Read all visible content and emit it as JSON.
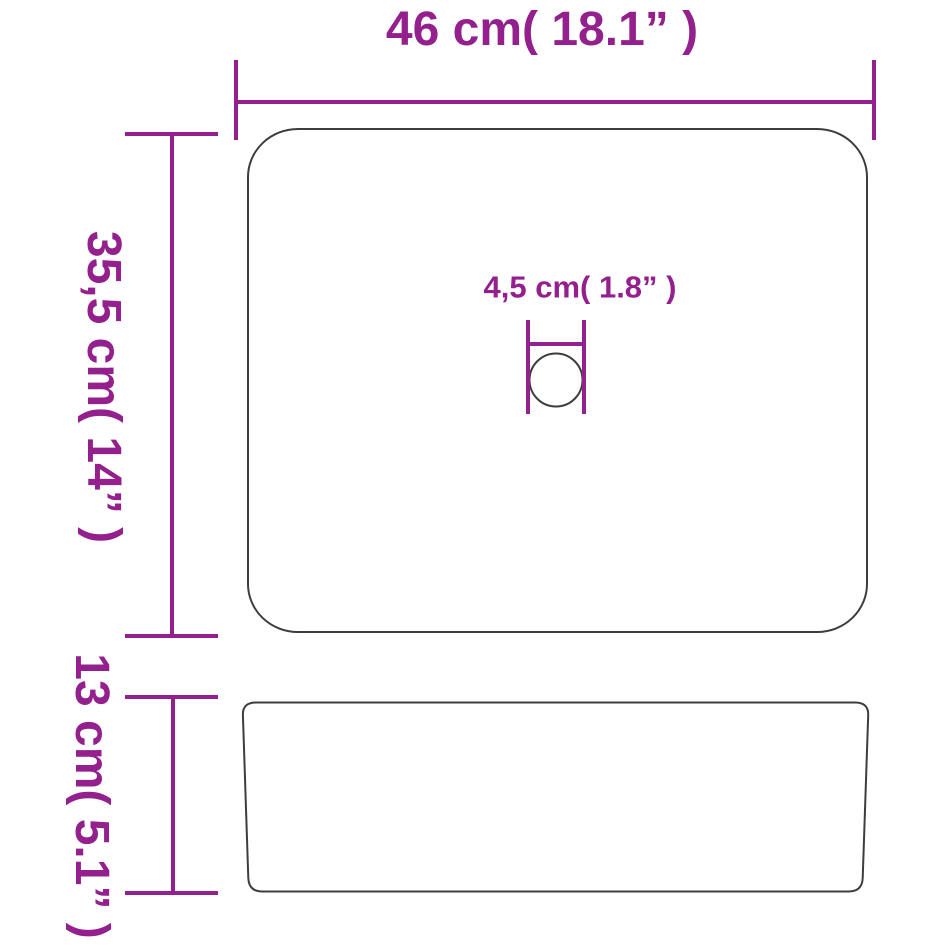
{
  "diagram": {
    "colors": {
      "accent": "#93208c",
      "outline": "#3d3d3d",
      "bg": "#ffffff"
    },
    "labels": {
      "width": "46 cm( 18.1”  )",
      "depth": "35,5 cm( 14”  )",
      "drain": "4,5 cm( 1.8”  )",
      "height": "13 cm( 5.1”  )"
    },
    "measurements": [
      {
        "name": "width",
        "cm": "46",
        "inches": "18.1"
      },
      {
        "name": "depth",
        "cm": "35,5",
        "inches": "14"
      },
      {
        "name": "drain_diameter",
        "cm": "4,5",
        "inches": "1.8"
      },
      {
        "name": "height",
        "cm": "13",
        "inches": "5.1"
      }
    ]
  }
}
